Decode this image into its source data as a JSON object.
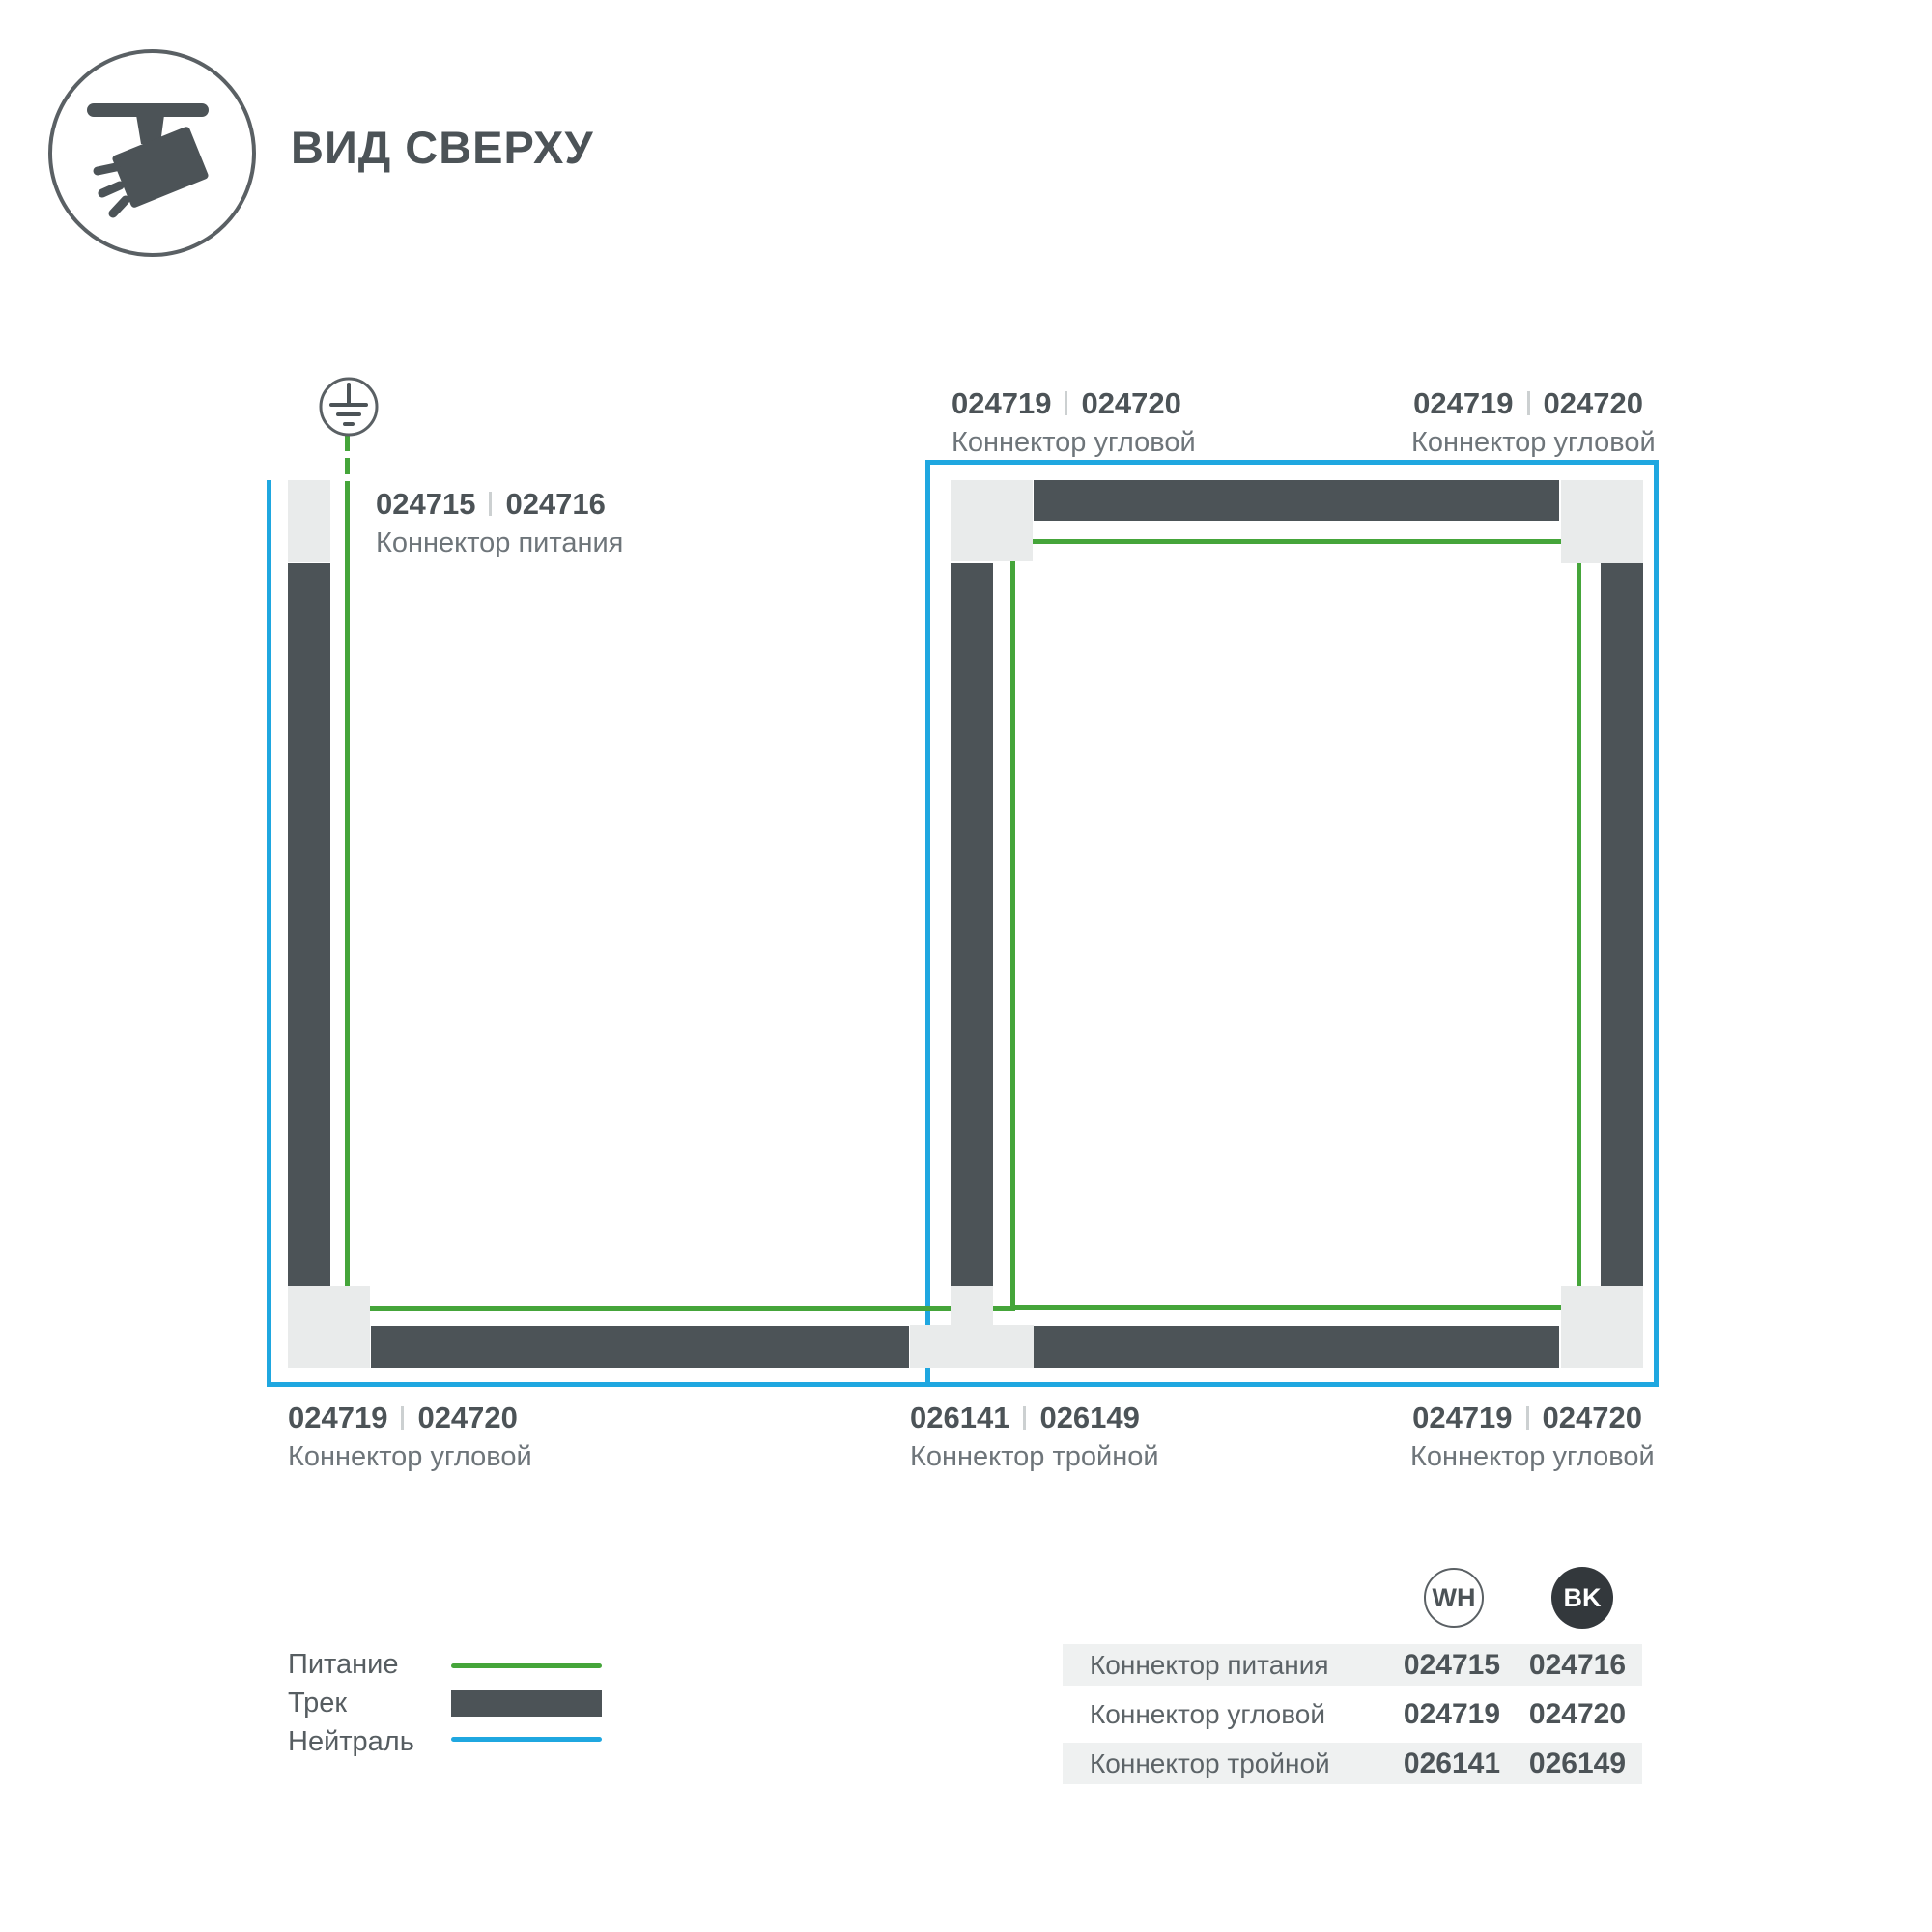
{
  "header": {
    "title": "ВИД СВЕРХУ"
  },
  "icons": {
    "track_light_icon": "track-spotlight",
    "ground_icon": "earth-ground-symbol"
  },
  "colors": {
    "track_dark": "#4c5357",
    "neutral_blue": "#1fa7e0",
    "power_green": "#45a53a",
    "connector_light": "#e9ebeb"
  },
  "connectors": {
    "power": {
      "wh": "024715",
      "bk": "024716",
      "name": "Коннектор питания"
    },
    "corner": {
      "wh": "024719",
      "bk": "024720",
      "name": "Коннектор угловой"
    },
    "triple": {
      "wh": "026141",
      "bk": "026149",
      "name": "Коннектор тройной"
    }
  },
  "legend": {
    "power_label": "Питание",
    "track_label": "Трек",
    "neutral_label": "Нейтраль"
  },
  "table": {
    "col_wh": "WH",
    "col_bk": "BK",
    "rows": [
      {
        "name": "Коннектор питания",
        "wh": "024715",
        "bk": "024716"
      },
      {
        "name": "Коннектор угловой",
        "wh": "024719",
        "bk": "024720"
      },
      {
        "name": "Коннектор тройной",
        "wh": "026141",
        "bk": "026149"
      }
    ]
  }
}
